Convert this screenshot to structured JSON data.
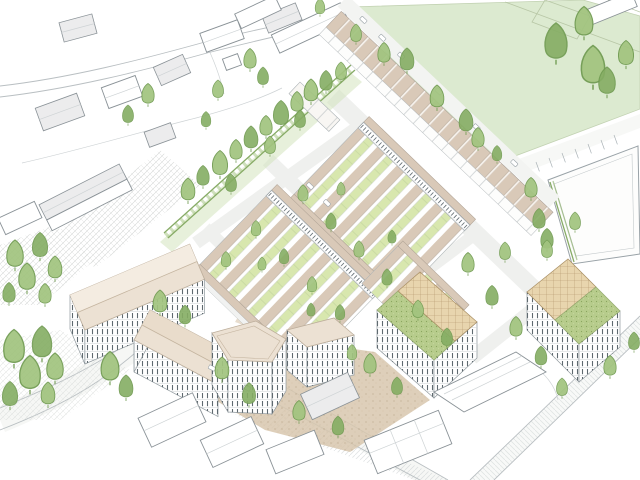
{
  "document": {
    "kind": "architectural-masterplan-aerial-sketch",
    "view": "axonometric aerial illustration, hand-drawn line style on white",
    "visible_text": ""
  },
  "palette": {
    "background": "#ffffff",
    "field_green": "#dcead0",
    "lawn_green": "#d8e7ae",
    "tree_green": "#a2c47f",
    "tree_green_dark": "#85ad63",
    "tree_stroke": "#6f9a50",
    "hedge_green": "#87ab66",
    "roof_beige": "#d9c9b8",
    "roof_cream": "#ece1d3",
    "roof_cream_light": "#f4ece1",
    "roof_cream_dark": "#e9dccb",
    "sedum_green": "#b7cc8c",
    "pergola_tan": "#e8d5ae",
    "plaza_tan": "#d8c7ae",
    "road_gray": "#f6f7f5",
    "hatch_gray": "#c9ced0",
    "sketch_line": "#8a9297",
    "existing_roof": "#ececed",
    "window_dark": "#5f6a70"
  },
  "scene": {
    "regions": [
      {
        "name": "playing-field",
        "description": "large green sports field, top right, faint pitch markings"
      },
      {
        "name": "existing-neighbourhood",
        "description": "outline-sketched houses with grey roofs, top left"
      },
      {
        "name": "terrace-row",
        "description": "long diagonal row of beige-roofed terraced houses along field edge"
      },
      {
        "name": "housing-blocks",
        "description": "perimeter blocks of terraces with green garden courtyards"
      },
      {
        "name": "apartment-complex-west",
        "description": "5-storey cream-roofed apartment wings with courtyard"
      },
      {
        "name": "pentagon-tower",
        "description": "7-storey tower with faceted plan and cream roof"
      },
      {
        "name": "sedum-roof-blocks",
        "description": "two flat blocks with green sedum roofs and timber pergolas, bottom right"
      },
      {
        "name": "plaza",
        "description": "tan paved square with trees between tall buildings"
      },
      {
        "name": "tree-buffer",
        "description": "dense green tree belt separating old and new housing"
      },
      {
        "name": "roads",
        "description": "hatched roads bottom left and bottom right, curving lanes top left"
      },
      {
        "name": "parking-court",
        "description": "white parking plot with bay ticks, right edge"
      }
    ]
  }
}
